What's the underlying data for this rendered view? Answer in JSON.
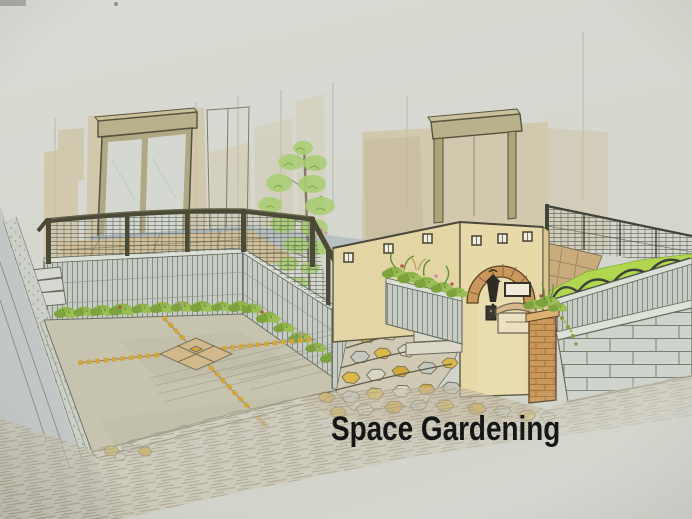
{
  "watermark": {
    "text": "Space Gardening",
    "color": "#161616"
  },
  "palette": {
    "paper": "#d7d9d1",
    "wall_wash": "#cfc2a0",
    "window_frame": "#b9b08c",
    "house_base": "#a9b2b8",
    "terrace_tile": "#d2bf98",
    "rail": "#4a4a37",
    "wall_block": "#c6cbc4",
    "mesh": "#4d554b",
    "shrub": "#8fb24a",
    "tree": "#abce74",
    "lawn": "#b2d74f",
    "drive": "#c6c3ae",
    "accent_tile": "#d4a53e",
    "motif_tile": "#d2b98c",
    "stucco": "#e4d5a4",
    "brick": "#c9985a",
    "stone_yellow": "#dcb84a",
    "stone_gray": "#c3c7bd",
    "street": "#c2c7c5",
    "pencil": "#a79d86",
    "block_wall": "#ced3cb"
  }
}
